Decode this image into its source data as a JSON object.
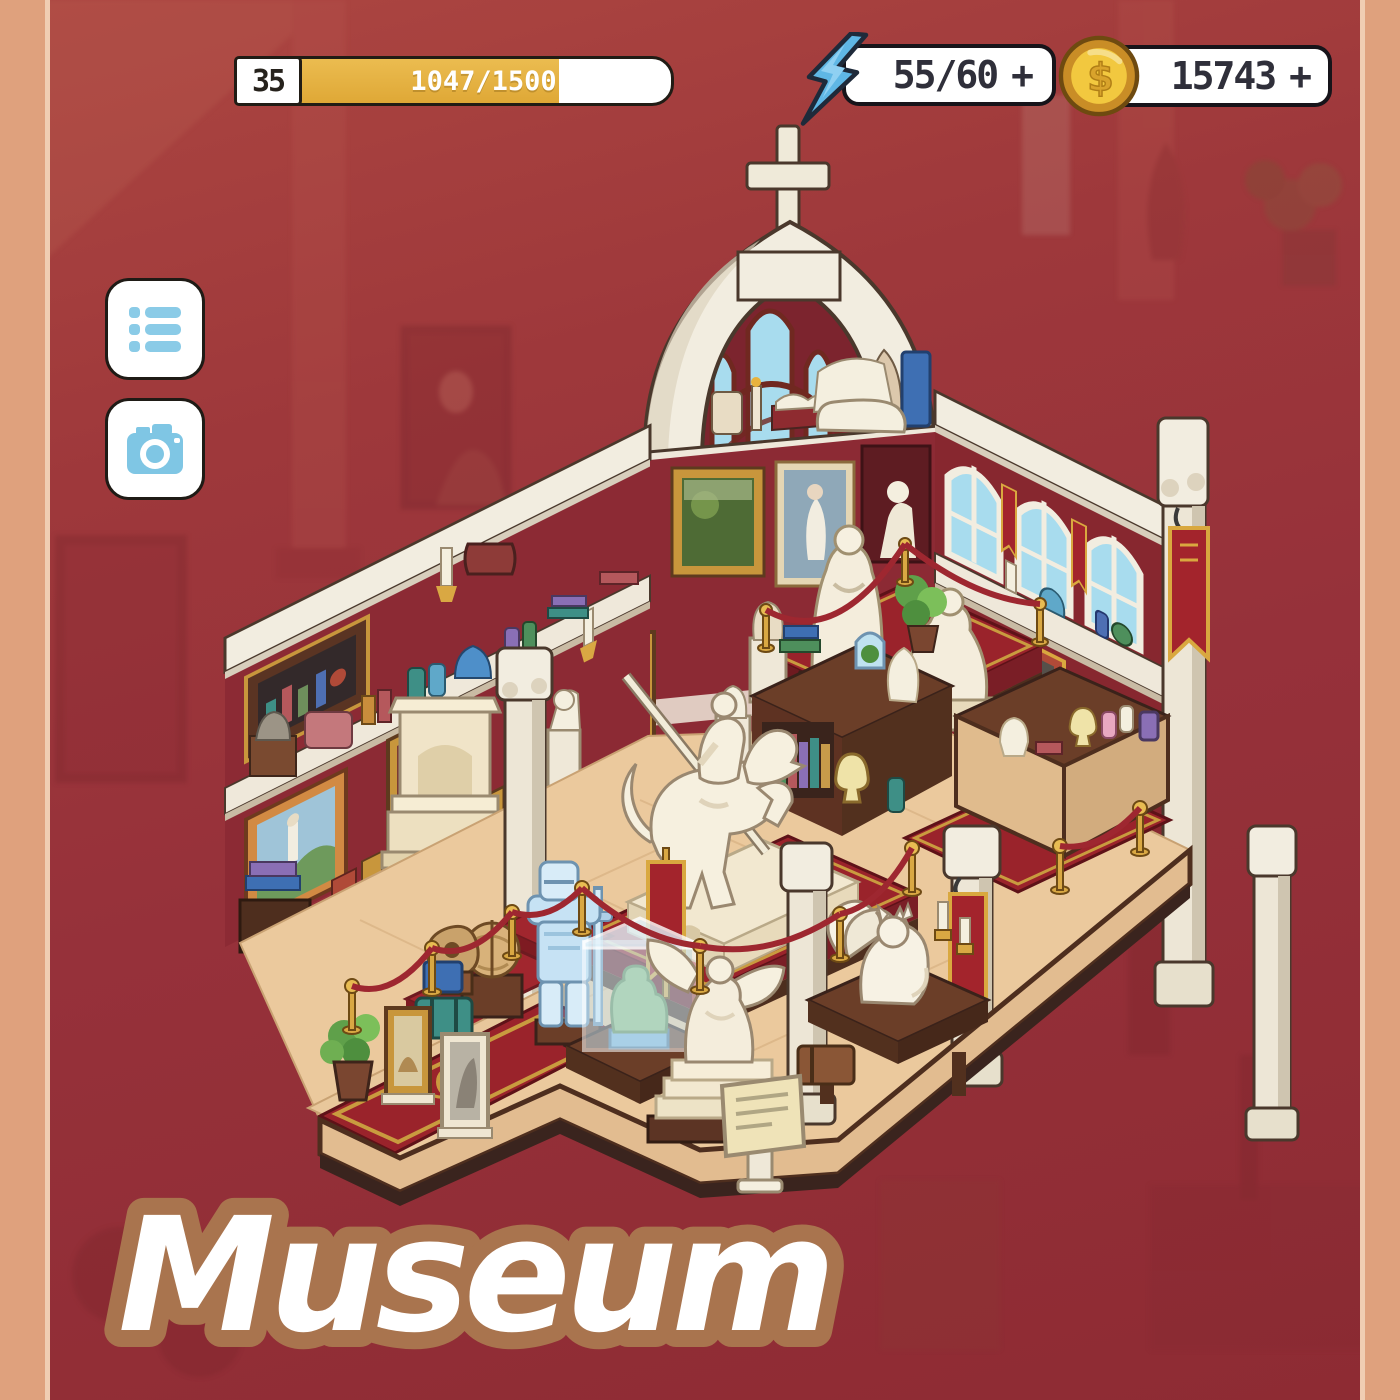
{
  "frame": {
    "border_color": "#DFA17D",
    "background_color": "#96313A"
  },
  "hud": {
    "level_badge": {
      "level": "35"
    },
    "xp_bar": {
      "label": "1047/1500",
      "percent": 70,
      "fill_color": "#E2AC3C"
    },
    "energy": {
      "label": "55/60",
      "plus": "+",
      "icon": "lightning-icon",
      "icon_color": "#5FB7E5"
    },
    "coins": {
      "label": "15743",
      "plus": "+",
      "icon": "coin-icon",
      "icon_color": "#EFBE3F"
    }
  },
  "side_menu": {
    "list_button": {
      "icon": "list-icon",
      "icon_color": "#8ACBE7"
    },
    "camera_button": {
      "icon": "camera-icon",
      "icon_color": "#7FC6E4"
    }
  },
  "room": {
    "title": "Museum",
    "title_fill": "#FFFFFF",
    "title_outline": "#A9744E",
    "landmarks": [
      "arch-with-cross",
      "stained-glass-window",
      "mona-lisa-painting",
      "knight-on-horse-statue",
      "angel-statue",
      "ice-knight-statue",
      "glass-display-case",
      "winged-fox-statue",
      "robed-statues",
      "fireplace",
      "bookshelf-tables",
      "red-carpet",
      "velvet-ropes",
      "marble-columns",
      "wall-banners"
    ]
  }
}
